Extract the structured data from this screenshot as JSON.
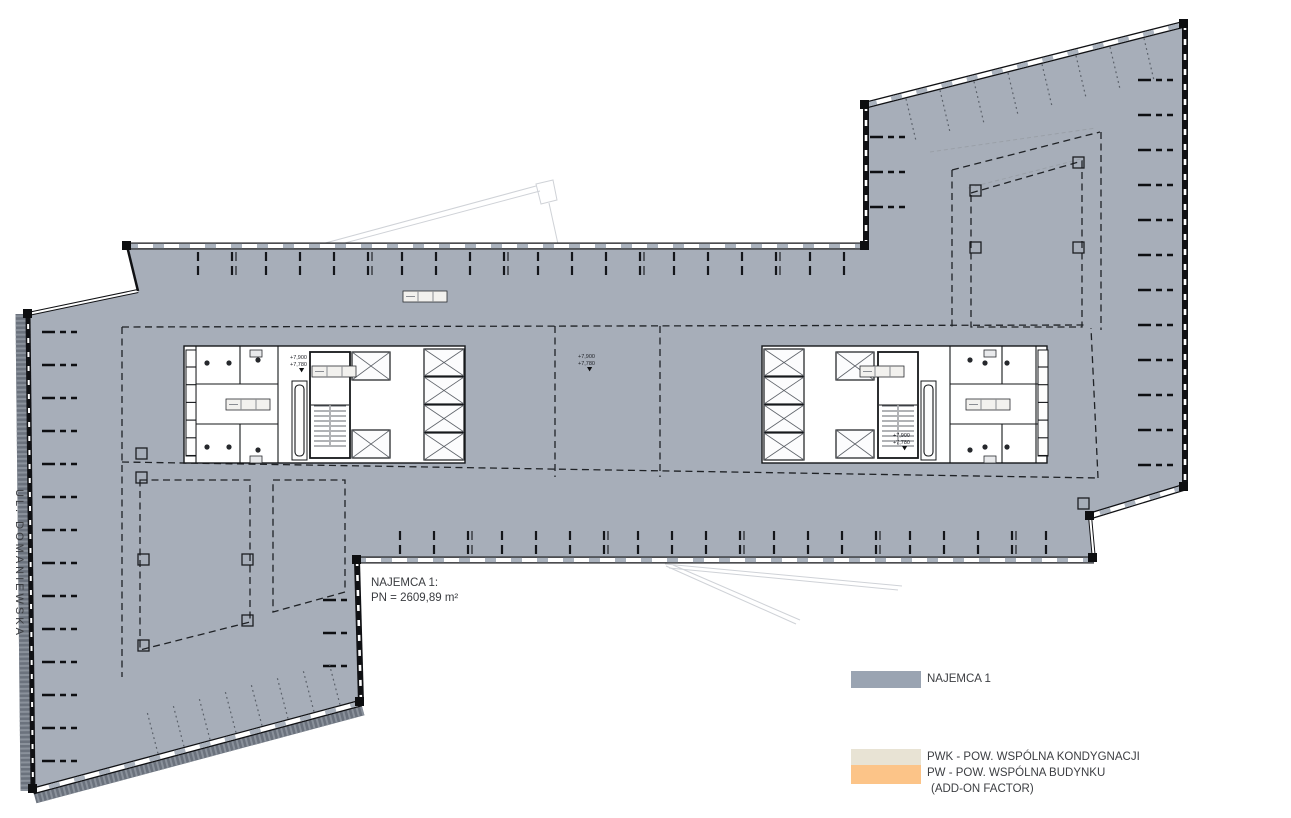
{
  "street_label": "UL. DOMANIEWSKA",
  "tenant_note": {
    "line1": "NAJEMCA 1:",
    "line2": "PN = 2609,89 m²"
  },
  "levels": {
    "upper": "+7,900",
    "lower": "+7,780"
  },
  "legend": {
    "items": [
      {
        "id": "najemca-1",
        "label": "NAJEMCA 1",
        "color": "#9aa4b2"
      },
      {
        "id": "pwk",
        "label": "PWK - POW. WSPÓLNA KONDYGNACJI",
        "color": "#e8e3d4"
      },
      {
        "id": "pw",
        "label": "PW - POW. WSPÓLNA BUDYNKU",
        "label2": "(ADD-ON FACTOR)",
        "color": "#fcc488"
      }
    ]
  },
  "colors": {
    "tenant_fill": "#a7aeb9",
    "facade_panel": "#aab2bd",
    "core_fill": "#ffffff"
  }
}
